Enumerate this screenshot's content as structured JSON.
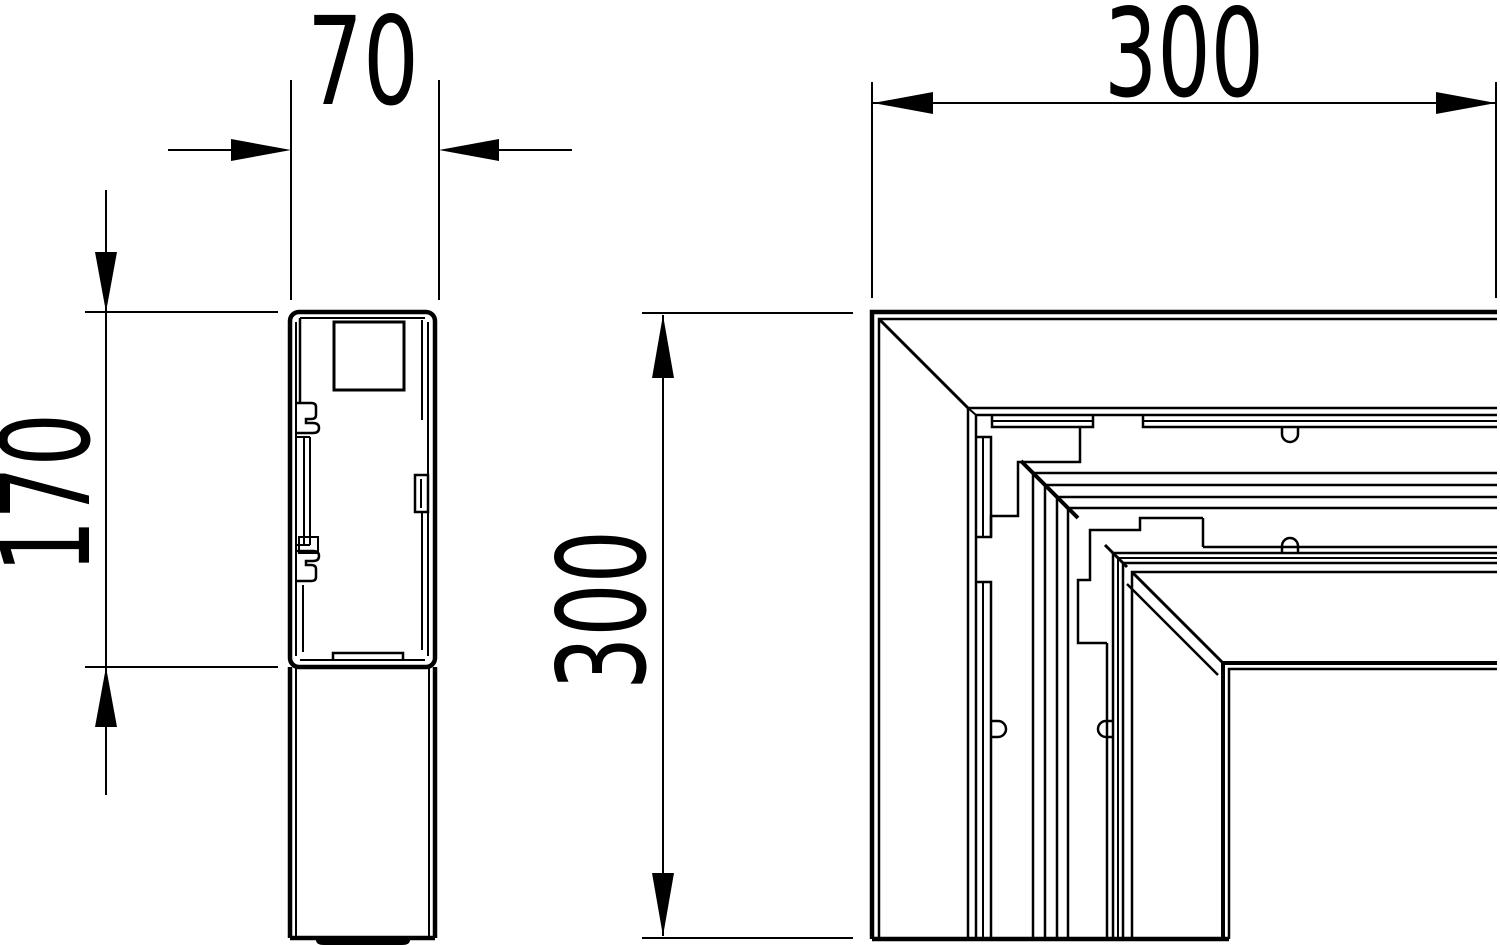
{
  "drawing": {
    "type": "technical-line-drawing",
    "description": "Two-view dimensioned drawing: trunking profile cross-section (left) and flat-angle corner view (right)",
    "colors": {
      "line": "#000000",
      "background": "#ffffff"
    }
  },
  "dimensions": {
    "profile_width": "70",
    "profile_height": "170",
    "corner_width": "300",
    "corner_height": "300"
  }
}
